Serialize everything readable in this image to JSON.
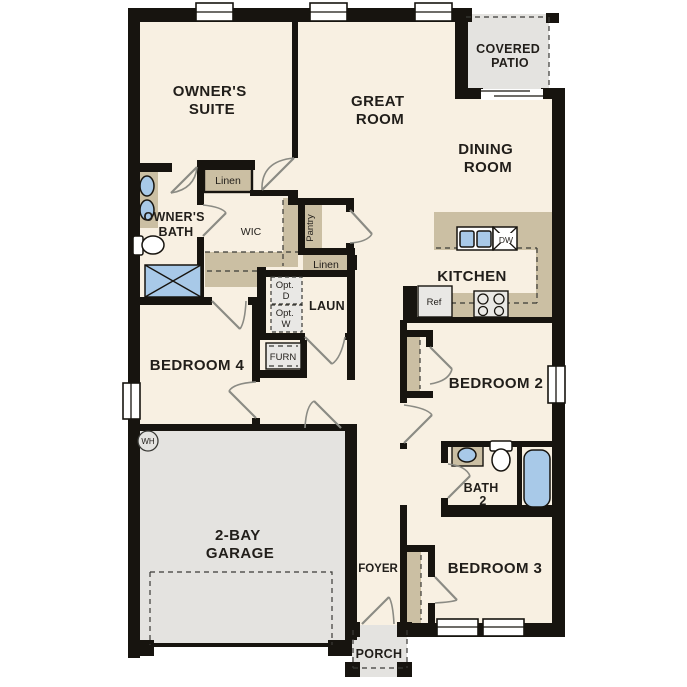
{
  "title": "Single-story floor plan",
  "palette": {
    "wall": "#17140f",
    "floor": "#f8f0e2",
    "tan": "#cbbfa3",
    "gray": "#e4e3e0",
    "grayLight": "#e9e8e5",
    "blue": "#a8c9e8",
    "arc": "#8b8b84",
    "dash": "#3a3a36",
    "label": "#211e1a"
  },
  "labels": {
    "owners_suite": [
      "OWNER'S",
      "SUITE"
    ],
    "great_room": [
      "GREAT",
      "ROOM"
    ],
    "covered_patio": [
      "COVERED",
      "PATIO"
    ],
    "dining_room": [
      "DINING",
      "ROOM"
    ],
    "kitchen": "KITCHEN",
    "owners_bath": [
      "OWNER'S",
      "BATH"
    ],
    "wic": "WIC",
    "linen_wic": "Linen",
    "pantry": "Pantry",
    "linen_hall": "Linen",
    "laundry": "LAUN",
    "opt_dryer": [
      "Opt.",
      "D"
    ],
    "opt_washer": [
      "Opt.",
      "W"
    ],
    "furnace": "FURN",
    "bedroom4": "BEDROOM 4",
    "bedroom2": "BEDROOM 2",
    "bath2": [
      "BATH",
      "2"
    ],
    "bedroom3": "BEDROOM 3",
    "garage": [
      "2-BAY",
      "GARAGE"
    ],
    "foyer": "FOYER",
    "porch": "PORCH",
    "water_heater": "WH",
    "refrigerator": "Ref",
    "dishwasher": "DW"
  }
}
